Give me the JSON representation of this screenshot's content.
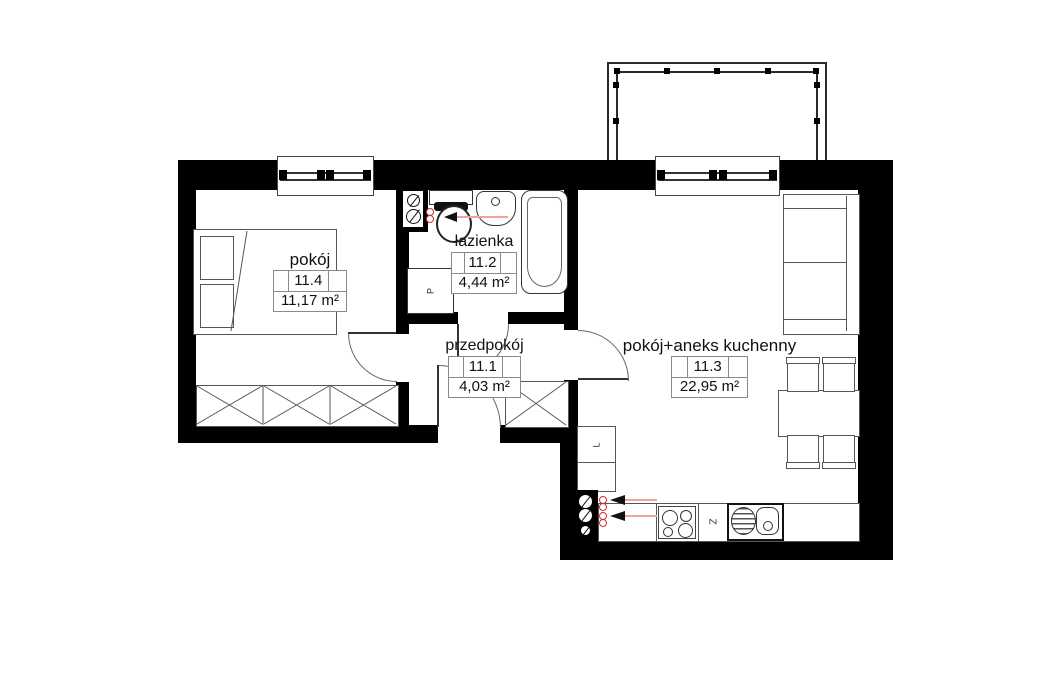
{
  "plan_title": "floor-plan",
  "rooms": [
    {
      "name": "pokój",
      "id": "11.4",
      "area": "11,17 m²"
    },
    {
      "name": "łazienka",
      "id": "11.2",
      "area": "4,44 m²"
    },
    {
      "name": "przedpokój",
      "id": "11.1",
      "area": "4,03 m²"
    },
    {
      "name": "pokój+aneks kuchenny",
      "id": "11.3",
      "area": "22,95 m²"
    }
  ],
  "appliances": {
    "washing_machine": "P",
    "fridge": "L",
    "dishwasher": "Z"
  },
  "colors": {
    "wall": "#000000",
    "line": "#555555",
    "dark": "#222222",
    "label_border": "#8a8a8a",
    "red": "#cc3333",
    "red_line": "#f2a0a0"
  }
}
